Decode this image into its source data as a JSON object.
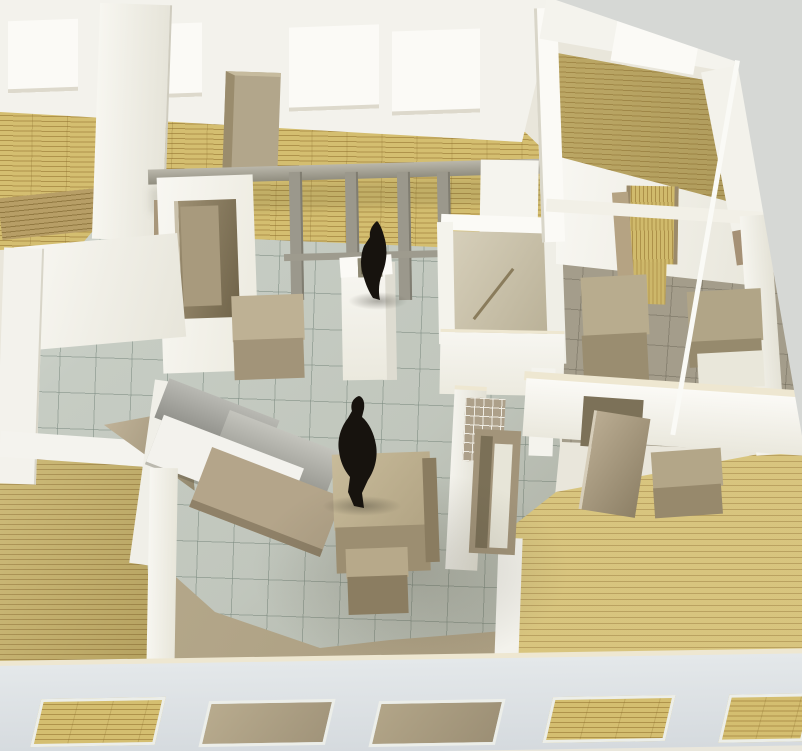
{
  "image": {
    "type": "photograph",
    "subject": "Architectural scale model (maquette) of an apartment floor plan seen from above at an oblique angle",
    "materials": [
      "white foam-board walls",
      "cardboard furniture and doors",
      "printed yellow plank flooring",
      "grey tiled floor sheet"
    ],
    "human_figures": 2,
    "visible_text": ""
  },
  "objects": {
    "exterior": [
      "top-exterior-wall-with-windows",
      "right-exterior-wall",
      "front-exterior-wall-with-windows",
      "table-surface-backdrop"
    ],
    "rooms": [
      "top-left-room",
      "top-centre-room",
      "top-right-room",
      "right-centre-room",
      "central-living-area",
      "left-corner-room",
      "terrace",
      "bottom-right-room"
    ],
    "furniture": [
      "tall-cabinet",
      "side-table",
      "central-table",
      "stacked-box",
      "kitchen-counter-unit",
      "shelving-divider",
      "wardrobe",
      "storage-blocks",
      "white-box"
    ],
    "details": [
      "glass-entrance-partition",
      "lintel-beam",
      "mullions",
      "central-column",
      "open-cardboard-doors",
      "black-figure-standing-at-entrance",
      "black-figure-beside-table",
      "small-open-top-room"
    ]
  },
  "palette": {
    "bg": "#d6d8d5",
    "wall": "#f3f2ec",
    "wall_bright": "#fbfaf6",
    "wall_shadow": "#e3e1d6",
    "cream": "#eee7d1",
    "front_wall": "#dde1e4",
    "front_wall_dark": "#ccd1d6",
    "plank": "#d4be70",
    "plank_muted": "#c8b36e",
    "tile": "#c6ccc3",
    "tile_dark": "#a6a899",
    "room_dark": "#a49d8b",
    "cardboard": "#b7aa8c",
    "cardboard_dark": "#998b6d",
    "cardboard_deep": "#80745a",
    "metal": "#a9a69b",
    "glass_frame": "#9b988c",
    "figure": "#17130e"
  }
}
